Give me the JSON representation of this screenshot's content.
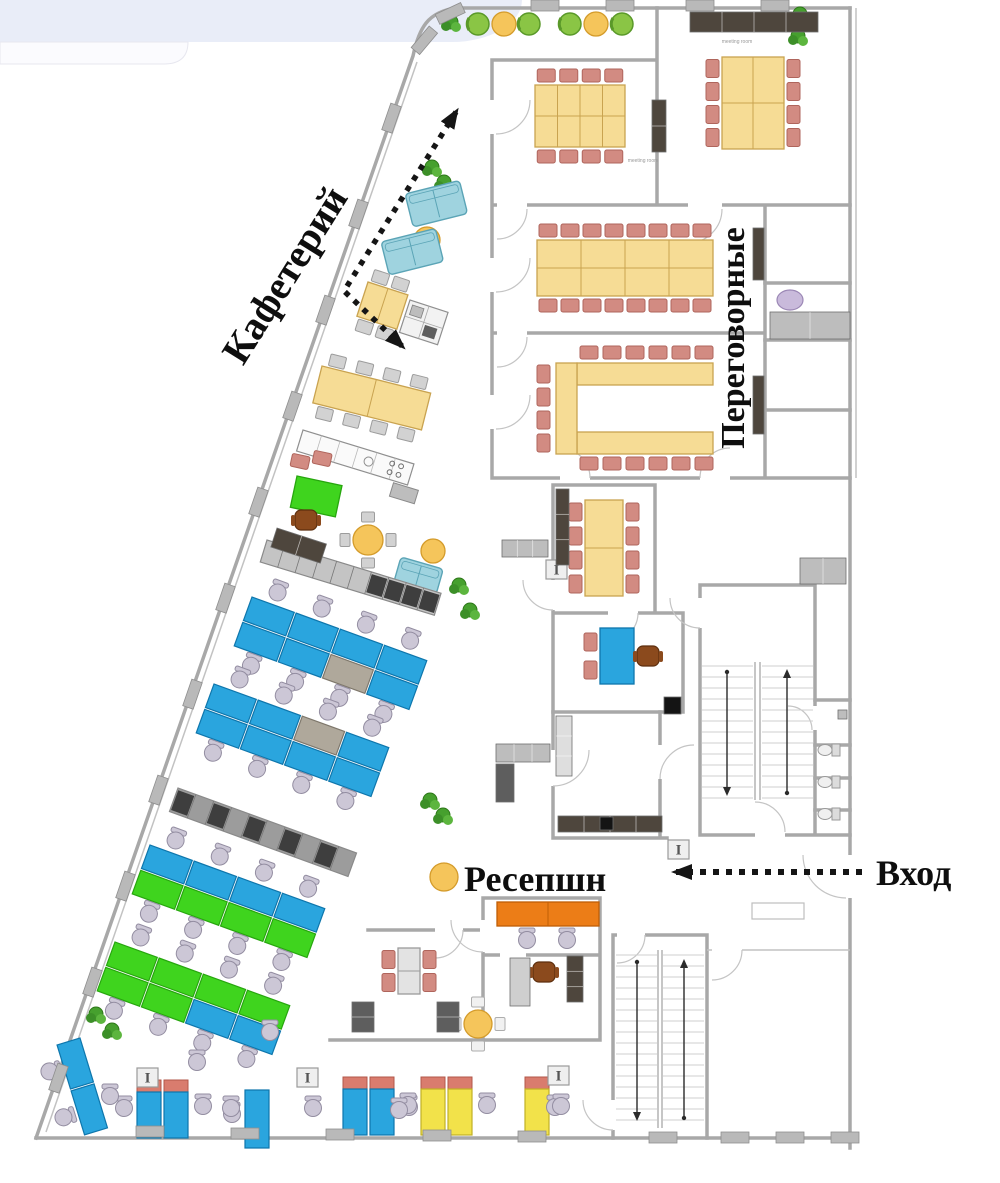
{
  "labels": {
    "cafeteria": "Кафетерий",
    "meeting_rooms": "Переговорные",
    "reception": "Ресепшн",
    "entrance": "Вход"
  },
  "room_labels": {
    "meeting_room_top_right": "meeting room",
    "meeting_room_1": "meeting room"
  },
  "colors": {
    "band": "#E9EDF8",
    "card": "#FBFBFE",
    "wall": "#A8A8A8",
    "desk_blue": "#2AA5DE",
    "desk_blue_stroke": "#0E76AC",
    "desk_green": "#3FD41E",
    "desk_green_stroke": "#27A60E",
    "desk_gray": "#AFA89B",
    "desk_gray_stroke": "#7E776B",
    "desk_yellow": "#F2E24A",
    "desk_yellow_stroke": "#C0B025",
    "red_top": "#D97C6E",
    "red_top_stroke": "#B25749",
    "table_yellow": "#F6DC95",
    "table_yellow_stroke": "#C9A350",
    "chair_pink": "#D28B82",
    "chair_pink_stroke": "#AF655C",
    "chair_gray": "#CCC7D6",
    "chair_gray_stroke": "#938DA1",
    "cafe_chair": "#D2D2D2",
    "cafe_chair_stroke": "#9C9C9C",
    "white_chair": "#F1F1F1",
    "white_chair_stroke": "#ADADAD",
    "sofa": "#9FD3DF",
    "sofa_stroke": "#5BA4B6",
    "accent_orange": "#EC7D17",
    "accent_orange_stroke": "#BF5E06",
    "circle_yellow": "#F5C55B",
    "circle_yellow_stroke": "#D49B2A",
    "lounge_green": "#8AC545",
    "lounge_green_stroke": "#5A9929",
    "plant": "#46A02E",
    "plant_stroke": "#2D7718",
    "locker_gray": "#BDBDBD",
    "locker_stroke": "#8A8A8A",
    "locker_dark": "#5E5E5E",
    "dark_cabinet": "#4E463D",
    "wood_brown": "#8B4A1D",
    "wood_brown_stroke": "#5D2F0E",
    "black": "#141414",
    "lilac_item": "#C9BADB",
    "lilac_item_stroke": "#9B87B5",
    "arrow": "#151515"
  },
  "furniture": {
    "bench_rows": [
      {
        "x": 252,
        "y": 597,
        "angle": 20,
        "uw": 47,
        "uh": 25,
        "top": [
          "b",
          "b",
          "b",
          "b"
        ],
        "bottom": [
          "b",
          "b",
          "gy",
          "b"
        ],
        "chairs": "both"
      },
      {
        "x": 214,
        "y": 684,
        "angle": 20,
        "uw": 47,
        "uh": 25,
        "top": [
          "b",
          "b",
          "gy",
          "b"
        ],
        "bottom": [
          "b",
          "b",
          "b",
          "b"
        ],
        "chairs": "both"
      },
      {
        "x": 150,
        "y": 845,
        "angle": 20,
        "uw": 47,
        "uh": 25,
        "top": [
          "b",
          "b",
          "b",
          "b"
        ],
        "bottom": [
          "g",
          "g",
          "g",
          "g"
        ],
        "chairs": "both"
      },
      {
        "x": 115,
        "y": 942,
        "angle": 20,
        "uw": 47,
        "uh": 25,
        "top": [
          "g",
          "g",
          "g",
          "g"
        ],
        "bottom": [
          "g",
          "g",
          "b",
          "b"
        ],
        "chairs": "both"
      },
      {
        "x": 80,
        "y": 1038,
        "angle": 73,
        "uw": 48,
        "uh": 24,
        "top": [
          "b",
          "b"
        ],
        "bottom": [],
        "chairs": "bottom"
      }
    ],
    "meeting_tables": [
      {
        "x": 722,
        "y": 57,
        "w": 62,
        "h": 92,
        "cols": 2,
        "rows": 2,
        "chairs": {
          "left": 4,
          "right": 4
        }
      },
      {
        "x": 535,
        "y": 85,
        "w": 90,
        "h": 62,
        "cols": 4,
        "rows": 2,
        "chairs": {
          "top": 4,
          "bottom": 4
        }
      },
      {
        "x": 537,
        "y": 240,
        "w": 176,
        "h": 56,
        "cols": 4,
        "rows": 2,
        "chairs": {
          "top": 8,
          "bottom": 8
        }
      },
      {
        "x": 585,
        "y": 500,
        "w": 38,
        "h": 96,
        "cols": 1,
        "rows": 2,
        "chairs": {
          "left": 4,
          "right": 4
        }
      },
      {
        "x": 600,
        "y": 628,
        "w": 34,
        "h": 56,
        "cols": 1,
        "rows": 1,
        "chairs": {
          "left": 2
        },
        "fill": "desk_blue",
        "stroke": "desk_blue_stroke"
      },
      {
        "x": 398,
        "y": 948,
        "w": 22,
        "h": 46,
        "cols": 1,
        "rows": 2,
        "chairs": {
          "left": 2,
          "right": 2
        },
        "fill": "#E3E3E3",
        "stroke": "#9B9B9B"
      },
      {
        "x": 497,
        "y": 902,
        "w": 102,
        "h": 24,
        "cols": 2,
        "rows": 1,
        "chairs": {},
        "fill": "accent_orange",
        "stroke": "accent_orange_stroke"
      }
    ],
    "u_table": {
      "bars": [
        [
          577,
          363,
          136,
          22
        ],
        [
          577,
          432,
          136,
          22
        ],
        [
          556,
          363,
          21,
          91
        ]
      ],
      "chairs_top": {
        "x0": 580,
        "y": 346,
        "n": 6,
        "dx": 23
      },
      "chairs_bottom": {
        "x0": 580,
        "y": 457,
        "n": 6,
        "dx": 23
      },
      "chairs_left": {
        "x": 537,
        "y0": 365,
        "n": 4,
        "dy": 23
      }
    },
    "round_items": [
      {
        "t": "plant",
        "x": 451,
        "y": 22
      },
      {
        "t": "g",
        "x": 478,
        "y": 24
      },
      {
        "t": "y",
        "x": 504,
        "y": 24
      },
      {
        "t": "g",
        "x": 529,
        "y": 24
      },
      {
        "t": "g",
        "x": 570,
        "y": 24
      },
      {
        "t": "y",
        "x": 596,
        "y": 24
      },
      {
        "t": "g",
        "x": 622,
        "y": 24
      },
      {
        "t": "plant",
        "x": 800,
        "y": 14
      },
      {
        "t": "plant",
        "x": 798,
        "y": 36
      },
      {
        "t": "plant",
        "x": 432,
        "y": 167
      },
      {
        "t": "plant",
        "x": 444,
        "y": 182
      },
      {
        "t": "plant",
        "x": 459,
        "y": 585
      },
      {
        "t": "plant",
        "x": 470,
        "y": 610
      },
      {
        "t": "plant",
        "x": 430,
        "y": 800
      },
      {
        "t": "plant",
        "x": 443,
        "y": 815
      },
      {
        "t": "plant",
        "x": 96,
        "y": 1014
      },
      {
        "t": "plant",
        "x": 112,
        "y": 1030
      },
      {
        "t": "y",
        "x": 427,
        "y": 240,
        "r": 13
      },
      {
        "t": "y",
        "x": 433,
        "y": 551,
        "r": 12
      },
      {
        "t": "y",
        "x": 444,
        "y": 877,
        "r": 14
      },
      {
        "t": "lilac",
        "x": 790,
        "y": 300
      }
    ],
    "round_table_sets": [
      {
        "cx": 368,
        "cy": 540,
        "r": 15,
        "chair": "gray"
      },
      {
        "cx": 478,
        "cy": 1024,
        "r": 14,
        "chair": "white"
      }
    ],
    "sofas": [
      {
        "x": 405,
        "y": 194,
        "angle": -14,
        "w": 56,
        "h": 34
      },
      {
        "x": 381,
        "y": 242,
        "angle": -14,
        "w": 56,
        "h": 34
      },
      {
        "x": 401,
        "y": 557,
        "angle": 16,
        "w": 44,
        "h": 26
      }
    ],
    "cafe_tables": [
      {
        "x": 368,
        "y": 282,
        "angle": 18,
        "w": 42,
        "h": 36,
        "top": 2,
        "bottom": 2
      },
      {
        "x": 322,
        "y": 366,
        "angle": 14,
        "w": 112,
        "h": 38,
        "top": 4,
        "bottom": 4
      }
    ],
    "green_table": {
      "x": 297,
      "y": 476,
      "angle": 12,
      "w": 46,
      "h": 32
    },
    "kitchen_counter": {
      "x": 303,
      "y": 430,
      "angle": 17,
      "w": 116,
      "h": 22
    },
    "appliance_counter": {
      "x": 410,
      "y": 300,
      "angle": 18,
      "w": 40,
      "h": 34
    },
    "lockers": [
      {
        "x": 267,
        "y": 540,
        "angle": 17,
        "len": 182,
        "dep": 23,
        "segs": 10,
        "fill": "#C4C4C4",
        "dark": [
          6,
          7,
          8,
          9
        ]
      },
      {
        "x": 178,
        "y": 788,
        "angle": 20,
        "len": 190,
        "dep": 25,
        "segs": 10,
        "fill": "#9C9C9C",
        "dark": [
          0,
          2,
          4,
          6,
          8
        ]
      }
    ],
    "single_desks": [
      {
        "x": 137,
        "y": 1080,
        "units": 2,
        "color": "b",
        "red": true,
        "chairs": [
          [
            -13,
            28
          ],
          [
            66,
            26
          ]
        ]
      },
      {
        "x": 245,
        "y": 1090,
        "units": 1,
        "color": "b",
        "red": false,
        "chairs": [
          [
            -13,
            24
          ]
        ]
      },
      {
        "x": 343,
        "y": 1077,
        "units": 2,
        "color": "b",
        "red": true,
        "chairs": [
          [
            66,
            30
          ]
        ]
      },
      {
        "x": 421,
        "y": 1077,
        "units": 2,
        "color": "y",
        "red": true,
        "chairs": [
          [
            -13,
            28
          ],
          [
            66,
            28
          ]
        ]
      },
      {
        "x": 525,
        "y": 1077,
        "units": 1,
        "color": "y",
        "red": true,
        "chairs": [
          [
            30,
            30
          ]
        ]
      }
    ],
    "loose_chairs": [
      [
        110,
        1096
      ],
      [
        197,
        1062
      ],
      [
        231,
        1108
      ],
      [
        313,
        1108
      ],
      [
        399,
        1110
      ],
      [
        561,
        1106
      ],
      [
        270,
        1032
      ],
      [
        527,
        940
      ],
      [
        567,
        940
      ]
    ],
    "pink_chairs": [
      [
        300,
        462,
        12
      ],
      [
        322,
        459,
        12
      ]
    ],
    "brown_chairs": [
      [
        648,
        656
      ],
      [
        544,
        972
      ],
      [
        306,
        520
      ]
    ],
    "toilets": [
      [
        820,
        750
      ],
      [
        820,
        782
      ],
      [
        820,
        814
      ]
    ],
    "ibeam_columns": [
      [
        137,
        1068
      ],
      [
        297,
        1068
      ],
      [
        548,
        1066
      ],
      [
        546,
        560
      ],
      [
        668,
        840
      ]
    ],
    "wall_columns": [
      [
        391,
        118,
        109
      ],
      [
        358,
        214,
        109
      ],
      [
        325,
        310,
        109
      ],
      [
        292,
        406,
        109
      ],
      [
        258,
        502,
        109
      ],
      [
        225,
        598,
        109
      ],
      [
        192,
        694,
        109
      ],
      [
        158,
        790,
        109
      ],
      [
        125,
        886,
        109
      ],
      [
        92,
        982,
        109
      ],
      [
        58,
        1078,
        109
      ],
      [
        424,
        40,
        130
      ],
      [
        450,
        13,
        155
      ],
      [
        545,
        6,
        0
      ],
      [
        620,
        6,
        0
      ],
      [
        700,
        6,
        0
      ],
      [
        775,
        6,
        0
      ],
      [
        150,
        1132,
        0
      ],
      [
        245,
        1134,
        0
      ],
      [
        340,
        1135,
        0
      ],
      [
        437,
        1136,
        0
      ],
      [
        532,
        1137,
        0
      ],
      [
        663,
        1138,
        0
      ],
      [
        735,
        1138,
        0
      ],
      [
        790,
        1138,
        0
      ],
      [
        845,
        1138,
        0
      ]
    ],
    "misc_rects": [
      {
        "x": 690,
        "y": 12,
        "w": 128,
        "h": 20,
        "fill": "dark_cabinet",
        "segs": 4
      },
      {
        "x": 652,
        "y": 100,
        "w": 14,
        "h": 52,
        "fill": "dark_cabinet",
        "segs": 2
      },
      {
        "x": 753,
        "y": 228,
        "w": 11,
        "h": 52,
        "fill": "dark_cabinet"
      },
      {
        "x": 753,
        "y": 376,
        "w": 11,
        "h": 58,
        "fill": "dark_cabinet"
      },
      {
        "x": 770,
        "y": 312,
        "w": 80,
        "h": 27,
        "fill": "locker_gray",
        "segs": 2
      },
      {
        "x": 800,
        "y": 558,
        "w": 46,
        "h": 26,
        "fill": "locker_gray",
        "segs": 2
      },
      {
        "x": 556,
        "y": 489,
        "w": 13,
        "h": 76,
        "fill": "dark_cabinet",
        "segs": 3
      },
      {
        "x": 502,
        "y": 540,
        "w": 46,
        "h": 17,
        "fill": "locker_gray",
        "segs": 3
      },
      {
        "x": 496,
        "y": 744,
        "w": 54,
        "h": 18,
        "fill": "locker_gray",
        "segs": 3
      },
      {
        "x": 496,
        "y": 764,
        "w": 18,
        "h": 38,
        "fill": "locker_dark"
      },
      {
        "x": 556,
        "y": 716,
        "w": 16,
        "h": 60,
        "fill": "#DEDEDE",
        "segs": 3
      },
      {
        "x": 558,
        "y": 816,
        "w": 104,
        "h": 16,
        "fill": "dark_cabinet",
        "segs": 4
      },
      {
        "x": 600,
        "y": 817,
        "w": 13,
        "h": 13,
        "fill": "black"
      },
      {
        "x": 664,
        "y": 697,
        "w": 17,
        "h": 17,
        "fill": "black"
      },
      {
        "x": 352,
        "y": 1002,
        "w": 22,
        "h": 30,
        "fill": "locker_dark",
        "segs": 2
      },
      {
        "x": 437,
        "y": 1002,
        "w": 22,
        "h": 30,
        "fill": "locker_dark",
        "segs": 2
      },
      {
        "x": 567,
        "y": 956,
        "w": 16,
        "h": 46,
        "fill": "dark_cabinet",
        "segs": 3
      },
      {
        "x": 510,
        "y": 958,
        "w": 20,
        "h": 48,
        "fill": "#CFCFCF"
      },
      {
        "x": 838,
        "y": 710,
        "w": 9,
        "h": 9,
        "fill": "locker_gray"
      },
      {
        "x": 277,
        "y": 528,
        "w": 52,
        "h": 20,
        "fill": "dark_cabinet",
        "segs": 2,
        "angle": 18
      }
    ]
  }
}
